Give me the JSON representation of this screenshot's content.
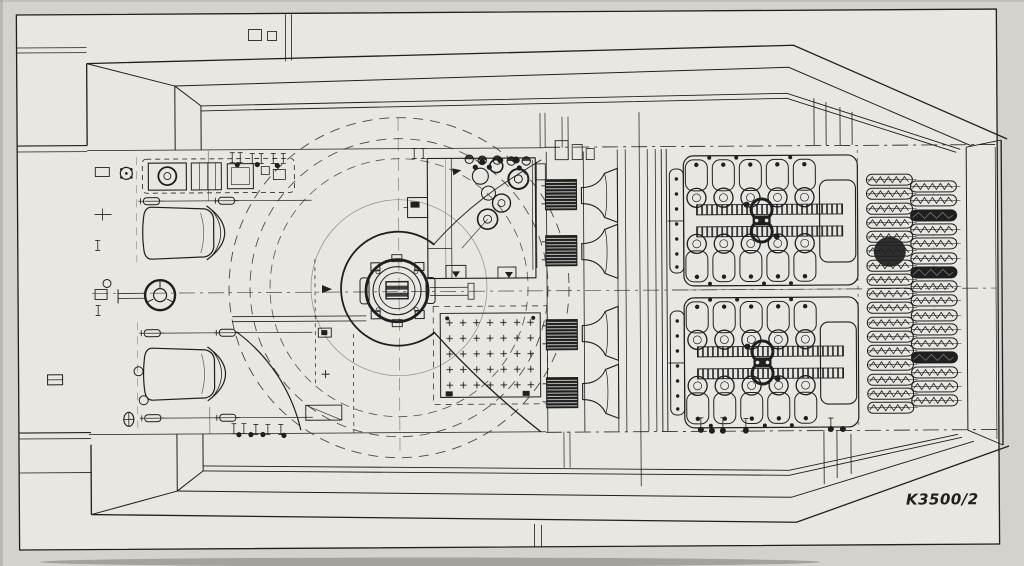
{
  "drawing": {
    "number": "K3500/2"
  },
  "colors": {
    "ink": "#1f1f1f",
    "paper": "#d5d2cd",
    "sheet": "#e9e7e2"
  }
}
